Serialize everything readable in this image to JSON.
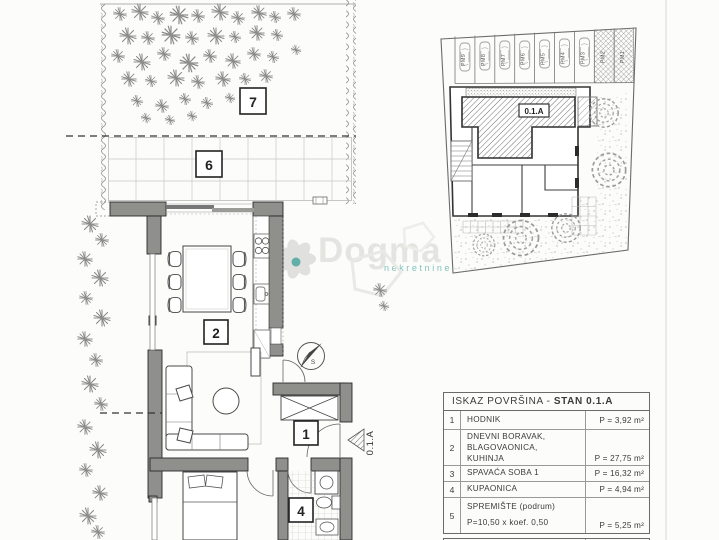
{
  "watermark": {
    "brand": "Dogma",
    "subtitle": "nekretnine",
    "brand_color": "#e4e4e1",
    "subtitle_color": "#5fb3ab"
  },
  "floor_plan": {
    "labels": {
      "garden": "7",
      "terrace": "6",
      "living": "2",
      "hall": "1",
      "bath": "4"
    },
    "unit_code_vertical": "0.1.A",
    "compass": "S"
  },
  "site_plan": {
    "unit_badge": "0.1.A",
    "parking": [
      "PM9",
      "PM8",
      "PM7",
      "PM6",
      "PM5",
      "PM4",
      "PM3",
      "PM2",
      "PM1"
    ]
  },
  "area_table": {
    "title_prefix": "ISKAZ POVRŠINA - ",
    "title_bold": "STAN 0.1.A",
    "rows": [
      {
        "num": "1",
        "lines": [
          "HODNIK"
        ],
        "value": "P = 3,92 m²"
      },
      {
        "num": "2",
        "lines": [
          "DNEVNI BORAVAK,",
          "BLAGOVAONICA,",
          "KUHINJA"
        ],
        "value": "P = 27,75 m²"
      },
      {
        "num": "3",
        "lines": [
          "SPAVAĆA SOBA 1"
        ],
        "value": "P = 16,32 m²"
      },
      {
        "num": "4",
        "lines": [
          "KUPAONICA"
        ],
        "value": "P = 4,94 m²"
      },
      {
        "num": "5",
        "lines": [
          "SPREMIŠTE (podrum)",
          "P=10,50 x koef. 0,50"
        ],
        "value": "P = 5,25 m²"
      }
    ],
    "total_label": "STAN UKUPNO:",
    "total_value": "P = 58,18 m²"
  }
}
